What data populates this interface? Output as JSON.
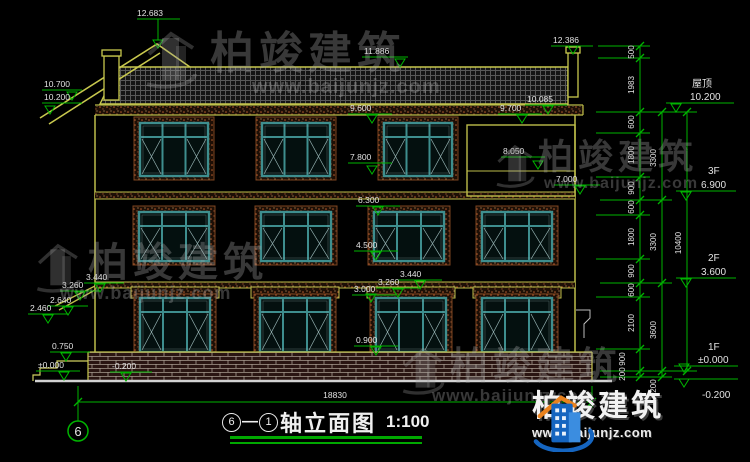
{
  "watermark": {
    "brand": "柏竣建筑",
    "url": "www.baijunjz.com"
  },
  "logo": {
    "brand": "柏竣建筑",
    "url": "www.baijunjz.com"
  },
  "title": {
    "axis_from": "6",
    "separator": "—",
    "axis_to": "1",
    "text": "轴立面图",
    "scale": "1:100",
    "grid_bubble": "6"
  },
  "levels_left": {
    "ridge": "12.683",
    "eave_hi": "10.700",
    "eave_lo": "10.200",
    "porch_top_hi": "3.440",
    "porch_top_lo": "3.260",
    "porch_bot_hi": "2.640",
    "porch_bot_lo": "2.460",
    "plinth": "0.750",
    "zero": "±0.000",
    "minus": "-0.200"
  },
  "levels_mid": {
    "ridge": "11.886",
    "chimney": "12.386",
    "eave": "10.085",
    "f3_head": "9.600",
    "balcony_top": "9.700",
    "balcony_head": "8.050",
    "f3_sill": "7.800",
    "slab": "7.000",
    "f2_head": "6.300",
    "f2_sill": "4.500",
    "lintel_hi": "3.440",
    "lintel_mid": "3.260",
    "f1_head": "3.000",
    "f1_sill": "0.900"
  },
  "levels_right": {
    "roof_label": "屋顶",
    "roof": "10.200",
    "f3_label": "3F",
    "f3": "6.900",
    "f2_label": "2F",
    "f2": "3.600",
    "f1_label": "1F",
    "f1": "±0.000",
    "minus": "-0.200"
  },
  "dims_right": {
    "top": [
      "500",
      "1983"
    ],
    "inner": [
      "600",
      "1800",
      "900",
      "600",
      "1800",
      "900",
      "600",
      "2100",
      "900",
      "200"
    ],
    "mid": [
      "3300",
      "3300",
      "3600",
      "200"
    ],
    "total": "10400"
  },
  "dims_bottom": {
    "width": "18830"
  }
}
